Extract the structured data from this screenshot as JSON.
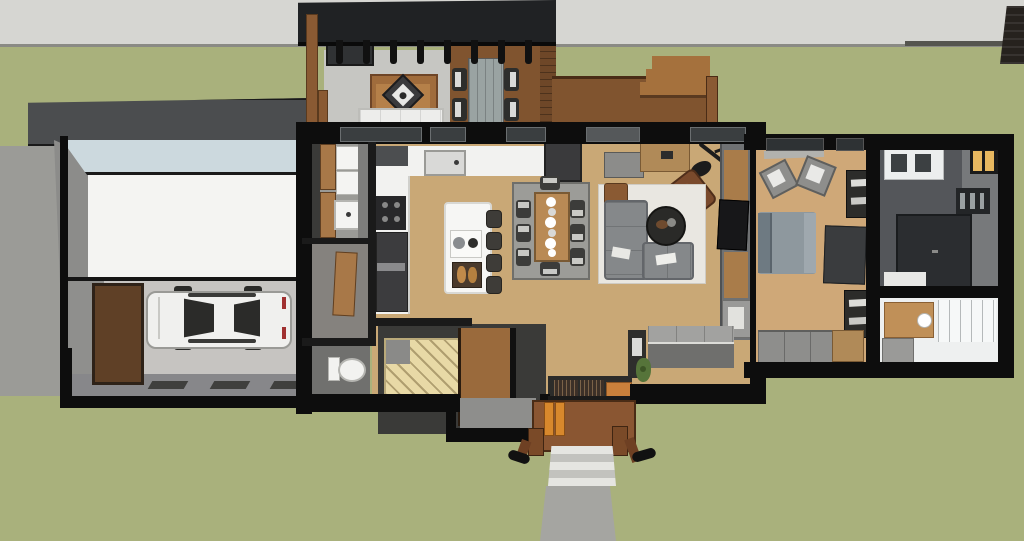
{
  "scene": {
    "title": "house-floorplan-overhead-render",
    "description": "SketchUp-style overhead cutaway render of a single-storey home: garage with car at left, covered deck pavilion at top, open kitchen/dining/living core, bedroom suite with two bathrooms at right, front porch with steps and walkway at bottom, lawn and road surround.",
    "view": "top-down 3d section"
  },
  "colors": {
    "grass": "#a9b17c",
    "road": "#d6d6d2",
    "roadEdge": "#55554f",
    "wall": "#0d0d0d",
    "innerWall": "#1a1a1a",
    "woodFloor": "#c9a876",
    "bedFloor": "#cfa878",
    "deck": "#80542f",
    "deckDark": "#4a2c16",
    "stepWood": "#a5713d",
    "roofBlack": "#202224",
    "garageRoofBand": "#4b4d4f",
    "gutter": "#ccd9de",
    "roofWhite": "#f4f4f2",
    "garageFloor": "#c6c4c1",
    "garageWallGrey": "#8c8c8a",
    "concrete": "#a5a5a1",
    "stepLight": "#e5e5e1",
    "stepMid": "#c2c2be",
    "rugLight": "#e9e7e1",
    "rugGray": "#9c9c98",
    "patioRug": "#c6c6c2",
    "counter": "#f2f2f0",
    "island": "#f6f6f4",
    "steel": "#d9d9d7",
    "sofaGray": "#85888a",
    "leather": "#7a4a2c",
    "tableWood": "#b98a55",
    "bedding": "#8e989e",
    "pillow": "#6e7a82",
    "tileWhite": "#eef0f0",
    "bathDark": "#54565a",
    "bathWallGrey": "#77797b",
    "amber": "#e8b860",
    "orangeDoor": "#d8882c",
    "entryRug": "#c9803c",
    "stairTan": "#e8d9a6",
    "stairWood": "#9a6a3c",
    "landing": "#8e8e8c",
    "cabinetDark": "#3a3a38",
    "woodCabinet": "#a87848",
    "mediaWood": "#a97c4a",
    "grayMid": "#6f7173",
    "benchTop": "#a2a2a0",
    "benchFront": "#6f6f6d",
    "carBody": "#f0f0ee",
    "glassDark": "#2b2b29",
    "plant": "#56743a",
    "fence": "#26221e",
    "driveway": "#9b9b97",
    "postBrown": "#7a4a28",
    "outdoorTable": "#9aa3a2",
    "chairDark": "#2e2e2c",
    "white": "#ededeb"
  },
  "rooms": [
    {
      "id": "garage",
      "name": "Garage",
      "items": [
        "white car",
        "brown paned side door",
        "concrete floor",
        "white roof plane",
        "metal roof band"
      ]
    },
    {
      "id": "pavilion",
      "name": "Covered deck pavilion",
      "items": [
        "black slat roof",
        "timber posts",
        "outdoor kitchen grill",
        "wood-frame sofa",
        "diamond-top coffee table",
        "white bench",
        "plank dining table",
        "four deck chairs"
      ]
    },
    {
      "id": "rear-deck",
      "name": "Rear deck",
      "items": [
        "board decking",
        "three steps to lawn",
        "corner post"
      ]
    },
    {
      "id": "mudroom",
      "name": "Mudroom / pantry",
      "items": [
        "tall cabinets",
        "stacked appliances",
        "utility sink",
        "closet with wood door"
      ]
    },
    {
      "id": "powder-room",
      "name": "Powder room",
      "items": [
        "toilet"
      ]
    },
    {
      "id": "kitchen",
      "name": "Kitchen",
      "items": [
        "L-shaped white counter",
        "sink",
        "cooktop",
        "oven tower",
        "fridge",
        "island",
        "four bar stools",
        "cutting board",
        "bread tray"
      ]
    },
    {
      "id": "dining",
      "name": "Dining area",
      "items": [
        "patterned gray rug",
        "wood table",
        "six upholstered chairs",
        "two end chairs",
        "place settings"
      ]
    },
    {
      "id": "living",
      "name": "Living room",
      "items": [
        "gray console",
        "wood sideboard",
        "arc floor lamp",
        "leather armchair",
        "hex-pattern rug",
        "L-sectional sofa",
        "round coffee table",
        "side table",
        "slatted media wall with TV",
        "window bench"
      ]
    },
    {
      "id": "entry",
      "name": "Entry",
      "items": [
        "slat doormats",
        "orange runner rug",
        "potted plant",
        "dark cabinet"
      ]
    },
    {
      "id": "stairs",
      "name": "Staircase",
      "items": [
        "tan winder steps",
        "wood stair run",
        "black railing",
        "gray landing"
      ]
    },
    {
      "id": "bedroom",
      "name": "Bedroom",
      "items": [
        "bed with gray duvet",
        "two accent chairs",
        "dark dresser",
        "wall shelves",
        "closet row with wood unit"
      ]
    },
    {
      "id": "bathroom-main",
      "name": "Main bathroom",
      "items": [
        "white double vanity",
        "walk-in dark shower",
        "towel shelf",
        "amber window",
        "white mat"
      ]
    },
    {
      "id": "bathroom-second",
      "name": "Second bathroom",
      "items": [
        "white tiled floor",
        "wood vanity",
        "glass shower panels",
        "gray fixture"
      ]
    },
    {
      "id": "porch",
      "name": "Front porch",
      "items": [
        "wood deck",
        "orange door leaves",
        "timber posts with black caps",
        "concrete steps",
        "walkway"
      ]
    }
  ],
  "site": {
    "road_position": "top",
    "driveway_position": "left",
    "walkway_position": "bottom-center",
    "fence_panel": "top-right"
  }
}
